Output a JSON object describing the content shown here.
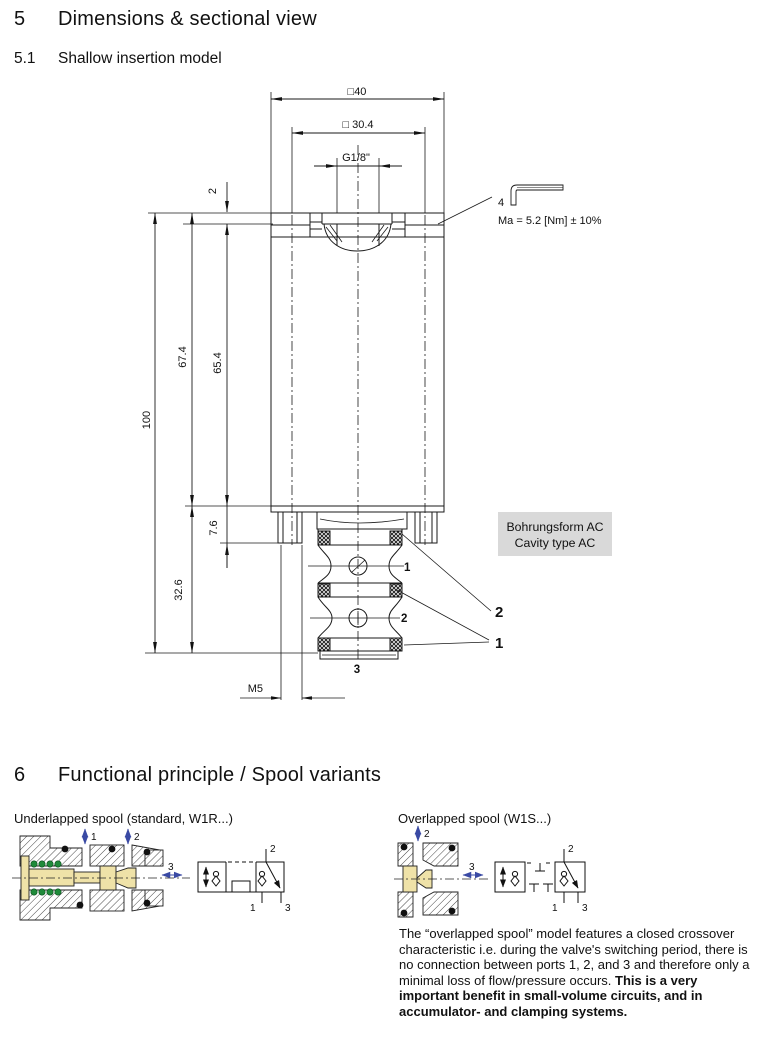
{
  "sections": {
    "s5": {
      "number": "5",
      "title": "Dimensions & sectional view"
    },
    "s51": {
      "number": "5.1",
      "title": "Shallow insertion model"
    },
    "s6": {
      "number": "6",
      "title": "Functional principle / Spool variants"
    }
  },
  "drawing": {
    "dim_width_outer": "□40",
    "dim_width_inner": "□ 30.4",
    "dim_thread": "G1/8\"",
    "dim_plate": "2",
    "dim_674": "67.4",
    "dim_654": "65.4",
    "dim_100": "100",
    "dim_76": "7.6",
    "dim_326": "32.6",
    "dim_m5": "M5",
    "hex_key_size": "4",
    "torque": "Ma = 5.2 [Nm] ± 10%",
    "cavity_note_line1": "Bohrungsform AC",
    "cavity_note_line2": "Cavity type AC",
    "port1": "1",
    "port2": "2",
    "port3": "3",
    "callout_seal_2": "2",
    "callout_seal_1": "1"
  },
  "underlapped": {
    "title": "Underlapped spool (standard, W1R...)",
    "arrow1": "1",
    "arrow2": "2",
    "arrow3": "3",
    "sym_port1": "1",
    "sym_port2": "2",
    "sym_port3": "3"
  },
  "overlapped": {
    "title": "Overlapped spool (W1S...)",
    "arrow2": "2",
    "arrow3": "3",
    "sym_port1": "1",
    "sym_port2": "2",
    "sym_port3": "3",
    "desc_normal": "The “overlapped spool” model features a closed crossover characteristic i.e. during the valve's switching period, there is no connection between ports 1, 2, and 3 and therefore only a minimal loss of flow/pressure occurs. ",
    "desc_bold": "This is a very important benefit in small-volume circuits, and in accumulator- and clamping systems."
  },
  "colors": {
    "arrow_blue": "#3a4aa4",
    "spool_yellow": "#efe2a8",
    "spring_green": "#1f8a3a",
    "note_bg": "#d9d9d9"
  }
}
